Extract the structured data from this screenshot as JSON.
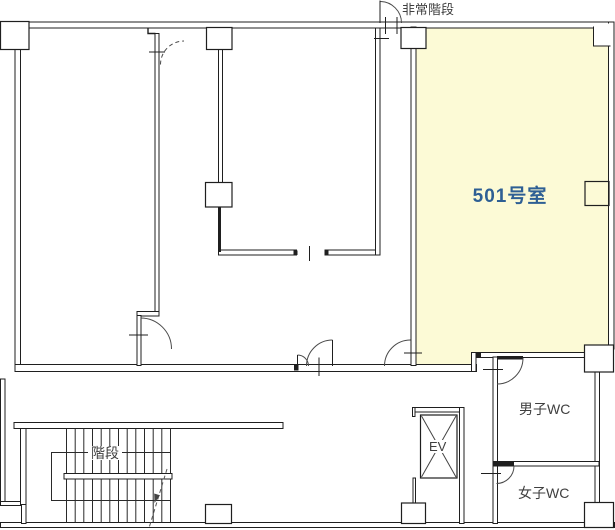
{
  "floor_plan": {
    "highlighted_room": {
      "label": "501号室",
      "fill": "#FCFAD6",
      "label_color": "#2E5F94"
    },
    "labels": {
      "emergency_stairs": "非常階段",
      "stairs": "階段",
      "elevator": "EV",
      "mens_wc": "男子WC",
      "womens_wc": "女子WC"
    },
    "colors": {
      "wall": "#1F1F1F",
      "label_text": "#3F3F3F",
      "background": "#FFFFFF"
    }
  }
}
